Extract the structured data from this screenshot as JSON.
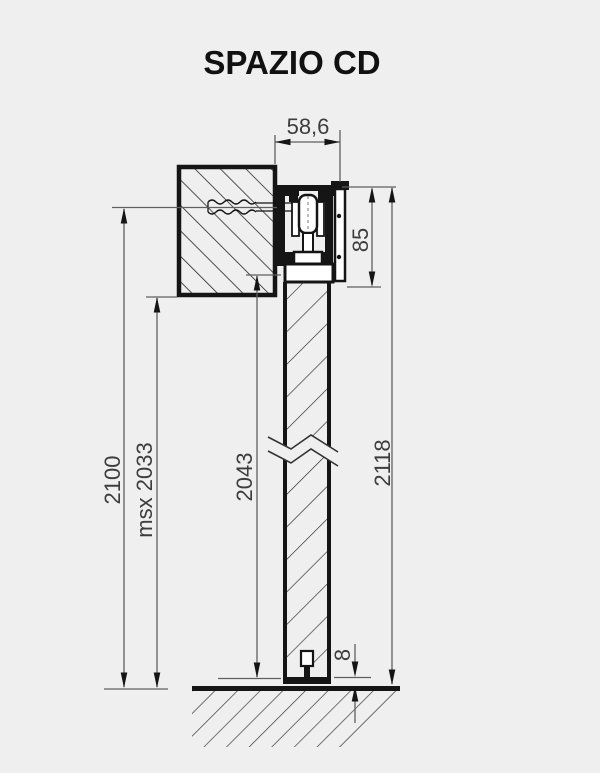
{
  "title": "SPAZIO CD",
  "drawing": {
    "dimensions": {
      "track_width": "58,6",
      "head_height": "85",
      "total_height": "2118",
      "door_panel_height": "2043",
      "opening_height": "2100",
      "msx_height": "msx 2033",
      "floor_clearance": "8"
    },
    "colors": {
      "background": "#efefef",
      "drawing_line": "#151515",
      "dimension_line": "#5f5f5f",
      "dimension_text": "#3d3d3d"
    }
  }
}
